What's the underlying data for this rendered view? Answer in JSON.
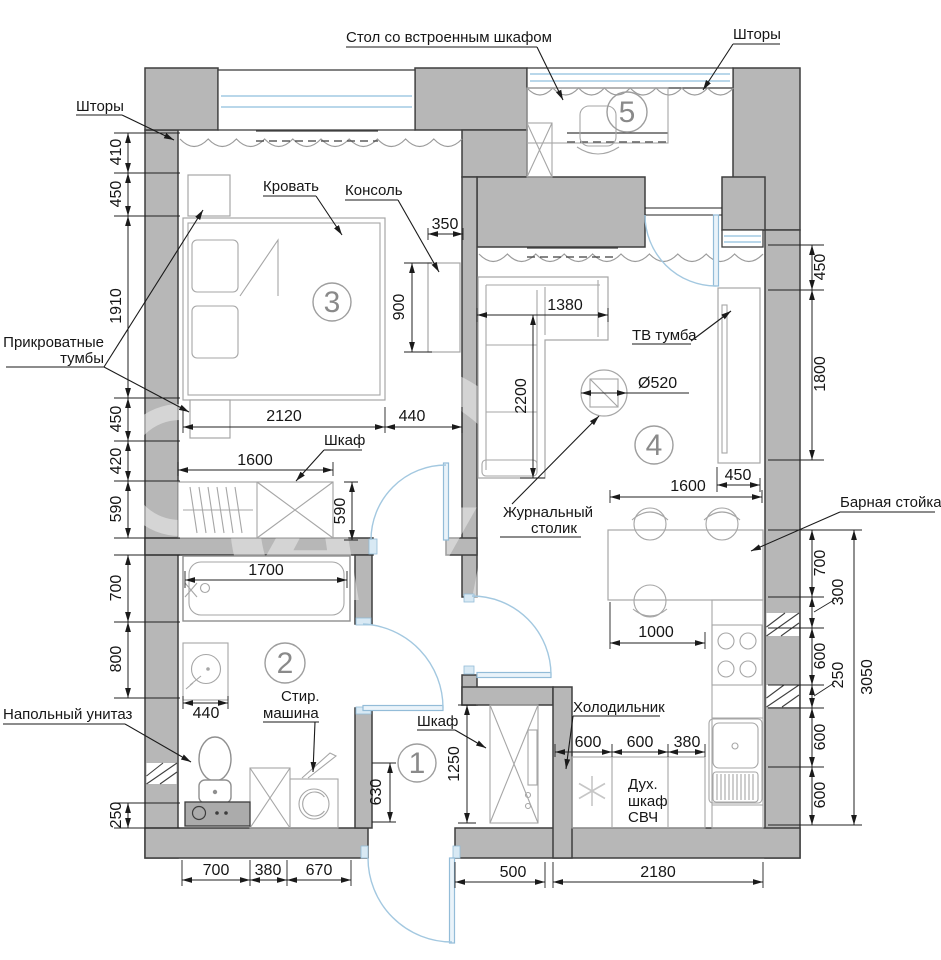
{
  "watermark": "Avito",
  "rooms": {
    "r1": "1",
    "r2": "2",
    "r3": "3",
    "r4": "4",
    "r5": "5"
  },
  "labels": {
    "desk": "Стол со встроенным шкафом",
    "curtains_right": "Шторы",
    "curtains_left": "Шторы",
    "bed": "Кровать",
    "console": "Консоль",
    "bedside_1": "Прикроватные",
    "bedside_2": "тумбы",
    "wardrobe_bedroom": "Шкаф",
    "tv": "ТВ тумба",
    "coffee_1": "Журнальный",
    "coffee_2": "столик",
    "bar": "Барная стойка",
    "toilet": "Напольный унитаз",
    "washer_1": "Стир.",
    "washer_2": "машина",
    "fridge": "Холодильник",
    "oven_1": "Дух.",
    "oven_2": "шкаф",
    "oven_3": "СВЧ",
    "wardrobe_hall": "Шкаф"
  },
  "dims": {
    "left": [
      "410",
      "450",
      "1910",
      "450",
      "420",
      "590",
      "700",
      "800",
      "250"
    ],
    "right_top": [
      "450",
      "1800"
    ],
    "right_bottom": [
      "700",
      "300",
      "600",
      "250",
      "600",
      "600"
    ],
    "right_total": "3050",
    "bottom_left": [
      "700",
      "380",
      "670"
    ],
    "bottom_right": [
      "500",
      "2180"
    ],
    "kitchen": [
      "600",
      "600",
      "380"
    ],
    "bedroom": {
      "bed_w": "2120",
      "bed_side": "440",
      "console_d": "350",
      "console_l": "900",
      "wardrobe_l": "1600",
      "wardrobe_d": "590"
    },
    "bath": {
      "tub": "1700",
      "sink": "440"
    },
    "living": {
      "sofa_l": "1380",
      "sofa_d": "2200",
      "table": "Ø520",
      "niche": "450",
      "bar_l": "1600",
      "bar_clear": "1000"
    },
    "hall": {
      "closet": "1250",
      "door_clear": "630"
    }
  }
}
